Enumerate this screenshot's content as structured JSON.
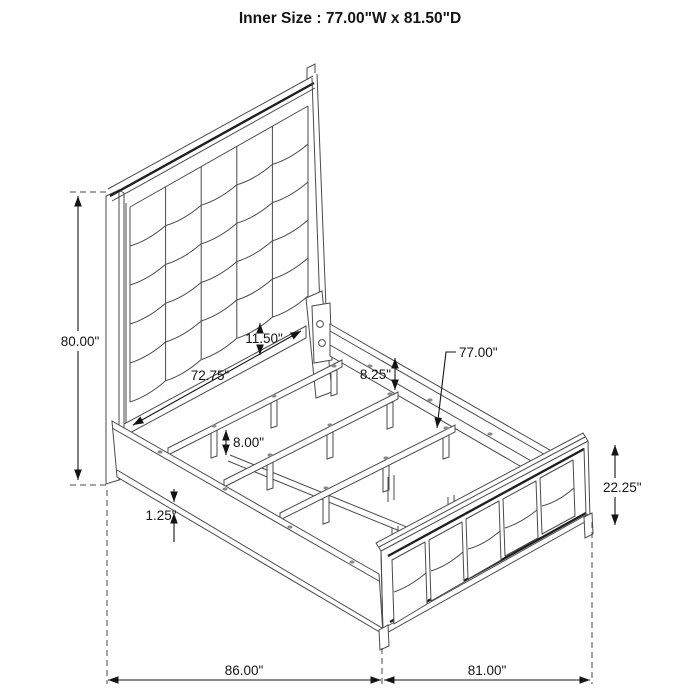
{
  "title": "Inner Size : 77.00\"W x 81.50\"D",
  "diagram_type": "bed-frame-dimension-line-drawing",
  "colors": {
    "background": "#ffffff",
    "line": "#4a4a4a",
    "accent_edge": "#1f1f1f",
    "dimension": "#141414"
  },
  "dimensions": {
    "headboard_height": "80.00\"",
    "cushion_to_rail_gap": "11.50\"",
    "headboard_inner_width": "72.75\"",
    "side_rail_height": "8.25\"",
    "slat_length": "77.00\"",
    "leg_height": "8.00\"",
    "rail_lip_thickness": "1.25\"",
    "footboard_height": "22.25\"",
    "overall_depth": "86.00\"",
    "overall_width": "81.00\""
  }
}
